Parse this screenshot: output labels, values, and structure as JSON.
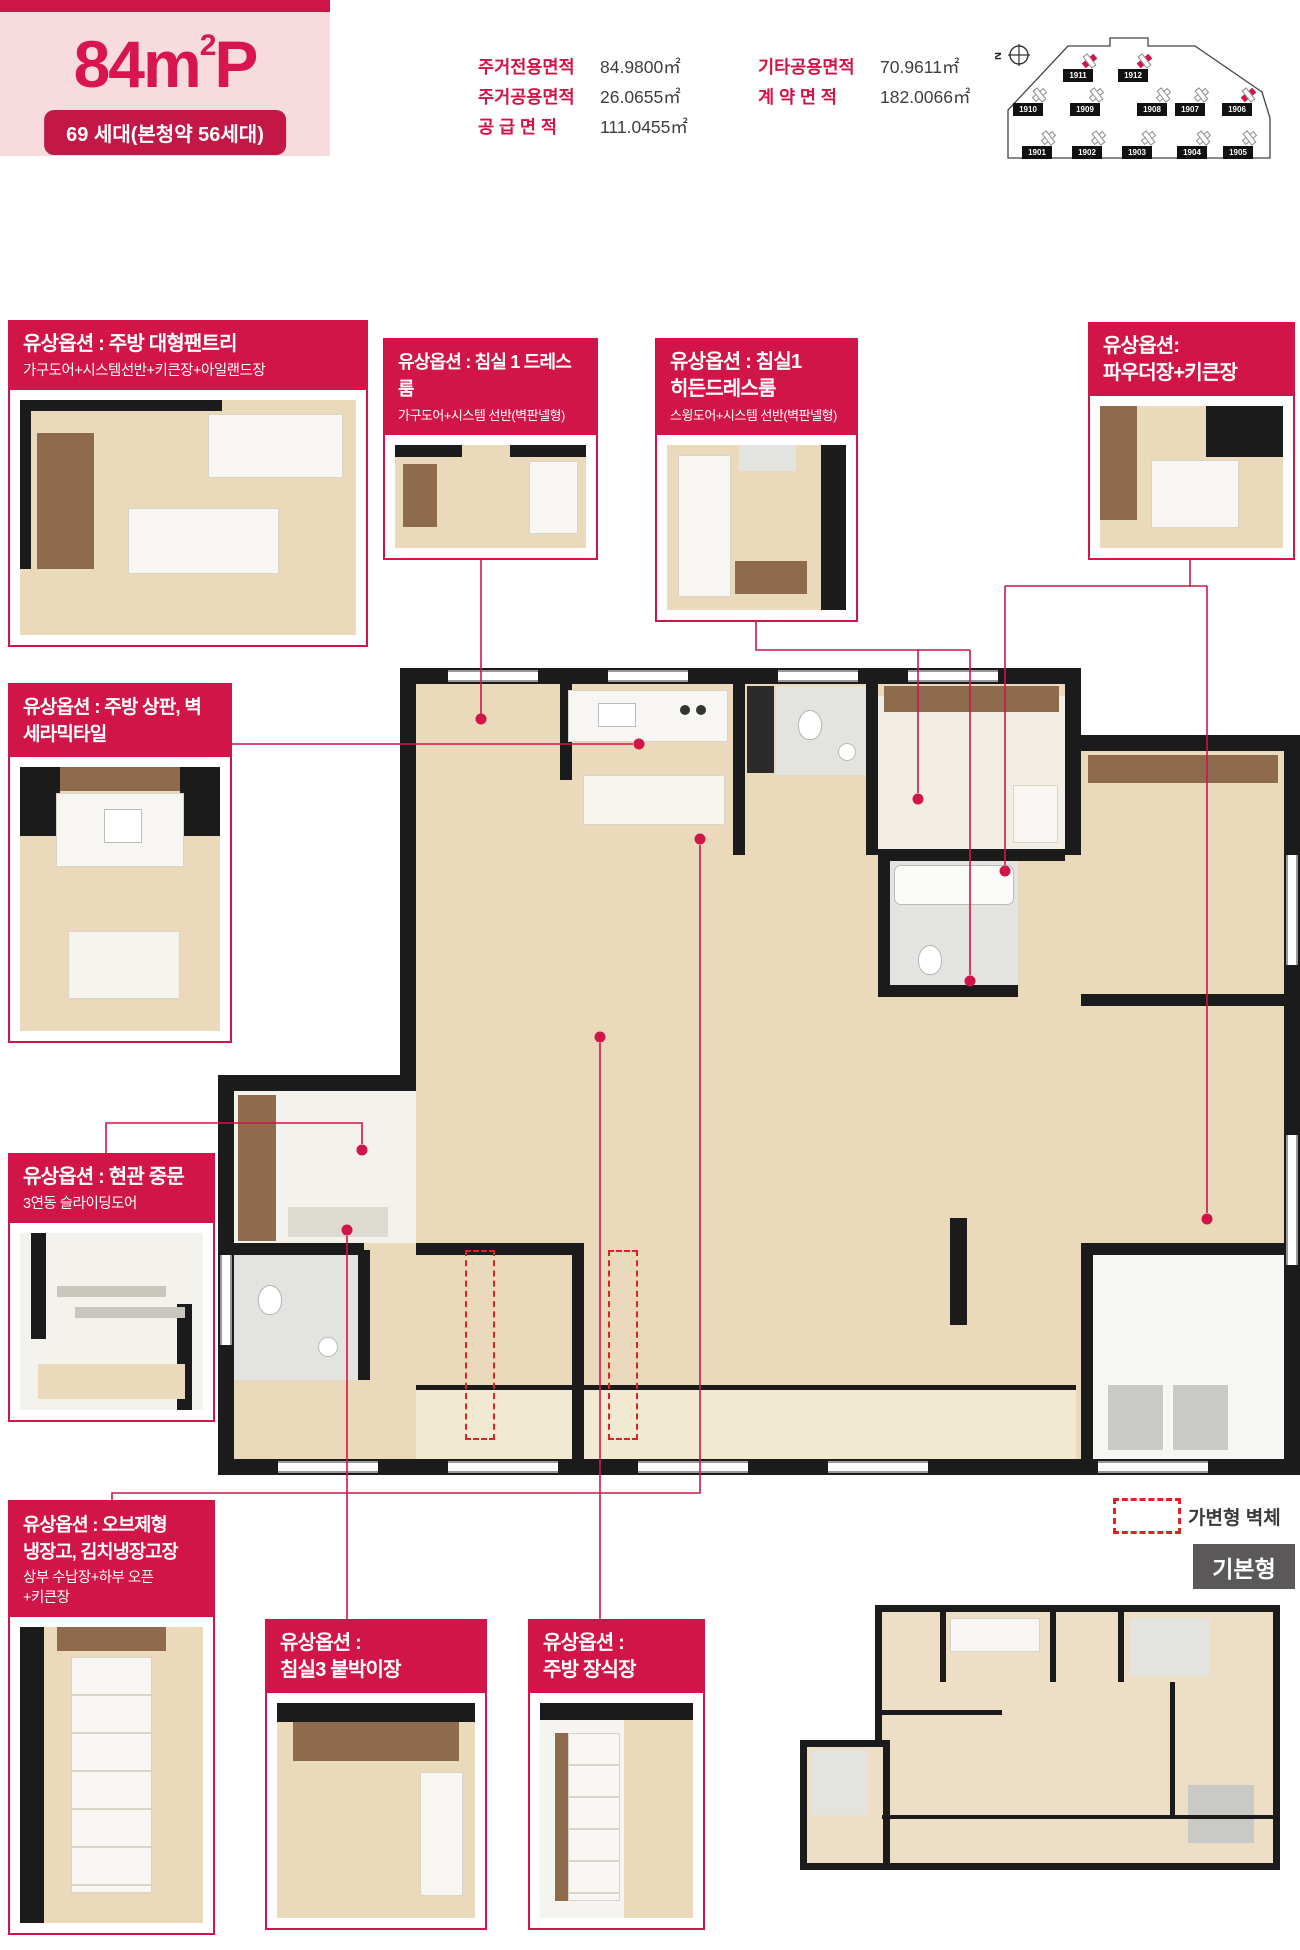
{
  "colors": {
    "accent": "#d11548",
    "badge": "#c21747",
    "header_pink": "#f8dbde",
    "title_text": "#d7164f",
    "wall": "#1b1b1b",
    "wood_floor": "#ead9ba",
    "tile": "#e3e4e0",
    "cabinet_brown": "#8d6b4c",
    "movable_wall_dash": "#e02222",
    "base_label_gray": "#5a5858"
  },
  "header": {
    "title_main": "84m",
    "title_sup": "2",
    "title_suffix": "P",
    "badge": "69 세대(본청약 56세대)"
  },
  "specs": [
    {
      "label": "주거전용면적",
      "value": "84.9800㎡"
    },
    {
      "label": "주거공용면적",
      "value": "26.0655㎡"
    },
    {
      "label": "공 급 면 적",
      "value": "111.0455㎡"
    },
    {
      "label": "기타공용면적",
      "value": "70.9611㎡"
    },
    {
      "label": "계 약 면 적",
      "value": "182.0066㎡"
    }
  ],
  "site": {
    "compass": "N",
    "buildings": [
      {
        "id": "1911",
        "highlight": true
      },
      {
        "id": "1912",
        "highlight": true
      },
      {
        "id": "1910",
        "highlight": false
      },
      {
        "id": "1909",
        "highlight": false
      },
      {
        "id": "1908",
        "highlight": false
      },
      {
        "id": "1907",
        "highlight": false
      },
      {
        "id": "1906",
        "highlight": true
      },
      {
        "id": "1901",
        "highlight": false
      },
      {
        "id": "1902",
        "highlight": false
      },
      {
        "id": "1903",
        "highlight": false
      },
      {
        "id": "1904",
        "highlight": false
      },
      {
        "id": "1905",
        "highlight": false
      }
    ]
  },
  "options": [
    {
      "title_lines": [
        "유상옵션 : 주방 대형팬트리"
      ],
      "subtitle_lines": [
        "가구도어+시스템선반+키큰장+아일랜드장"
      ]
    },
    {
      "title_lines": [
        "유상옵션 : 침실 1 드레스룸"
      ],
      "subtitle_lines": [
        "가구도어+시스템 선반(벽판넬형)"
      ]
    },
    {
      "title_lines": [
        "유상옵션 : 침실1",
        "히든드레스룸"
      ],
      "subtitle_lines": [
        "스윙도어+시스템 선반(벽판넬형)"
      ]
    },
    {
      "title_lines": [
        "유상옵션:",
        "파우더장+키큰장"
      ],
      "subtitle_lines": []
    },
    {
      "title_lines": [
        "유상옵션 : 주방 상판, 벽",
        "세라믹타일"
      ],
      "subtitle_lines": []
    },
    {
      "title_lines": [
        "유상옵션 : 현관 중문"
      ],
      "subtitle_lines": [
        "3연동 슬라이딩도어"
      ]
    },
    {
      "title_lines": [
        "유상옵션 : 오브제형",
        "냉장고, 김치냉장고장"
      ],
      "subtitle_lines": [
        "상부 수납장+하부 오픈",
        "+키큰장"
      ]
    },
    {
      "title_lines": [
        "유상옵션 :",
        "침실3 붙박이장"
      ],
      "subtitle_lines": []
    },
    {
      "title_lines": [
        "유상옵션 :",
        "주방 장식장"
      ],
      "subtitle_lines": []
    }
  ],
  "legend": {
    "label": "가변형 벽체"
  },
  "base_plan": {
    "label": "기본형"
  }
}
